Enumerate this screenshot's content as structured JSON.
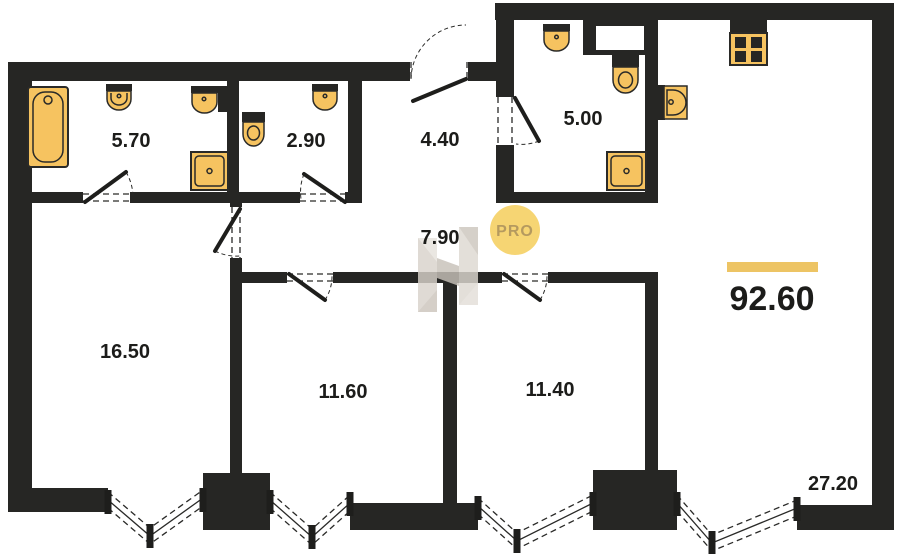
{
  "plan": {
    "title": "apartment-floor-plan",
    "total": {
      "area": "92.60"
    },
    "rooms": [
      {
        "id": "bathroom-1",
        "area": "5.70"
      },
      {
        "id": "wc",
        "area": "2.90"
      },
      {
        "id": "entrance-hall",
        "area": "4.40"
      },
      {
        "id": "bathroom-2",
        "area": "5.00"
      },
      {
        "id": "corridor",
        "area": "7.90"
      },
      {
        "id": "bedroom-1",
        "area": "16.50"
      },
      {
        "id": "bedroom-2",
        "area": "11.60"
      },
      {
        "id": "bedroom-3",
        "area": "11.40"
      },
      {
        "id": "kitchen-living",
        "area": "27.20"
      }
    ],
    "watermark": {
      "badge_label": "PRO",
      "logo": "letter-H-faceted-logo"
    },
    "icons": [
      "bathtub-icon",
      "sink-icon",
      "toilet-icon",
      "washing-machine-icon",
      "stove-icon",
      "kitchen-sink-icon",
      "door-swing",
      "bay-window"
    ],
    "colors": {
      "wall": "#262624",
      "fixture_fill": "#f6c360",
      "fixture_stroke": "#2a2a28",
      "accent_bar": "#edc464",
      "pro_circle": "#f6d573",
      "pro_text": "#b59a5f",
      "logo_gray": "#d8d2cb",
      "label_ink": "#1c1c1a"
    }
  }
}
